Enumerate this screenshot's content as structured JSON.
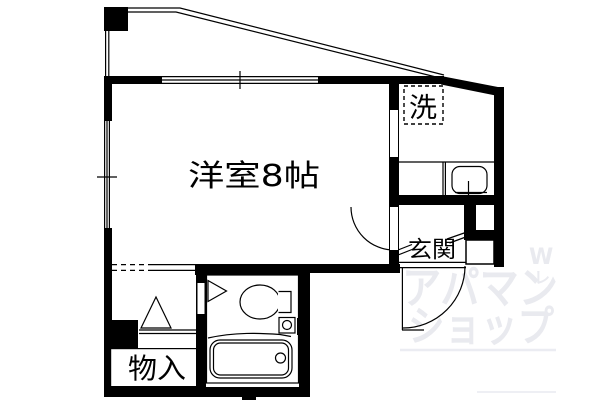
{
  "floorplan": {
    "rooms": {
      "main_room_label": "洋室8帖",
      "laundry_label": "洗",
      "entrance_label": "玄関",
      "storage_label": "物入"
    },
    "watermark": {
      "line1": "アパマン",
      "line2": "ショップ",
      "mark": "W",
      "mark_small": "レ",
      "color": "#e9eaef"
    },
    "colors": {
      "wall": "#000000",
      "background": "#ffffff"
    }
  }
}
